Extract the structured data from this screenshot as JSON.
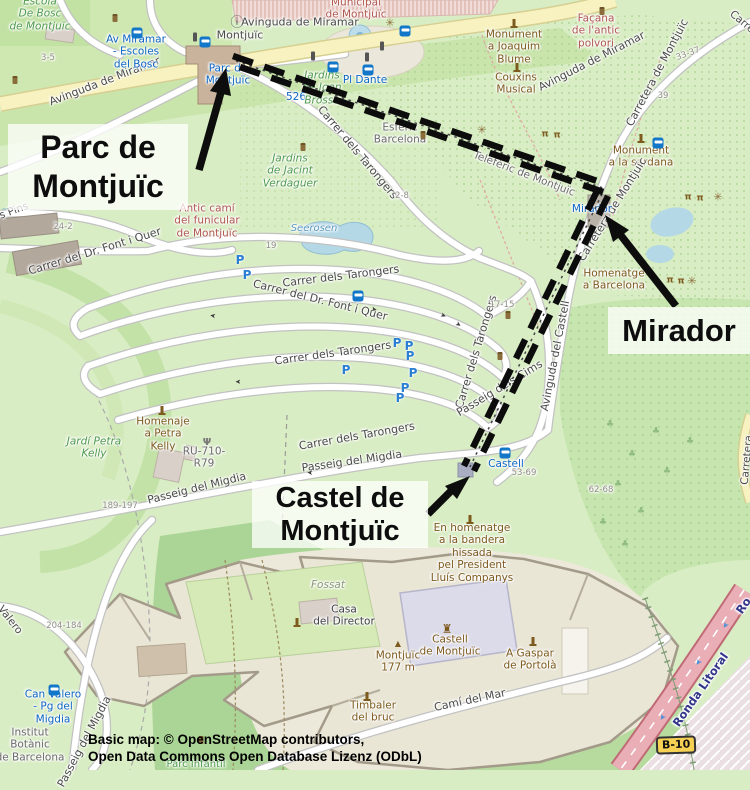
{
  "annotations": {
    "parc": "Parc de\nMontjuïc",
    "mirador": "Mirador",
    "castel": "Castel de\nMontjuïc"
  },
  "attribution": [
    "Basic map: © OpenStreetMap contributors,",
    "Open Data Commons Open Database Lizenz (ODbL)"
  ],
  "badges": {
    "b10": "B-10"
  },
  "colors": {
    "route": "#0c0c0c",
    "annotation_bg": "rgba(255,255,255,0.75)",
    "park_green": "#d9edc4",
    "forest_green": "#abd596",
    "water": "#b7d9e6",
    "road_yellow": "#f7f2c0",
    "trunk_red": "#e9aeb6",
    "transit_blue": "#0d66c3",
    "poi_brown": "#7d5a1e",
    "badge_yellow": "#f7d154"
  },
  "map_labels": [
    {
      "id": "escola-bosc",
      "text": "Escola\nDe Bosc\nde Montjuïc",
      "x": 40,
      "y": 14,
      "rot": 0,
      "cls": "gi"
    },
    {
      "id": "av-miramar-w",
      "text": "Avinguda de Miramar",
      "x": 105,
      "y": 82,
      "rot": -21,
      "cls": "st2"
    },
    {
      "id": "hn-3-5",
      "text": "3-5",
      "x": 48,
      "y": 58,
      "rot": 0,
      "cls": "hn"
    },
    {
      "id": "stop-av-miramar",
      "text": "Av Miramar\n- Escoles\ndel Bosc",
      "x": 136,
      "y": 52,
      "rot": 0,
      "cls": "tr"
    },
    {
      "id": "montjuic-street",
      "text": "Montjuïc",
      "x": 240,
      "y": 36,
      "rot": 0,
      "cls": "st2"
    },
    {
      "id": "municipal",
      "text": "Municipal\nde Montjuïc",
      "x": 356,
      "y": 9,
      "rot": 0,
      "cls": "ar"
    },
    {
      "id": "av-miramar-c",
      "text": "Avinguda de Miramar",
      "x": 300,
      "y": 23,
      "rot": 0,
      "cls": "st2"
    },
    {
      "id": "av-miramar-e",
      "text": "Avinguda de Miramar",
      "x": 592,
      "y": 62,
      "rot": -27,
      "cls": "st2"
    },
    {
      "id": "pl-dante",
      "text": "Pl Dante",
      "x": 365,
      "y": 80,
      "rot": 0,
      "cls": "tr"
    },
    {
      "id": "line-526",
      "text": "526",
      "x": 296,
      "y": 97,
      "rot": 0,
      "cls": "tr"
    },
    {
      "id": "jardins-brossa",
      "text": "Jardins\nde Joan\nBrossa",
      "x": 322,
      "y": 88,
      "rot": 0,
      "cls": "gi"
    },
    {
      "id": "stop-parc-montjuic",
      "text": "Parc de\nMontjuïc",
      "x": 228,
      "y": 75,
      "rot": 0,
      "cls": "tr"
    },
    {
      "id": "esferic",
      "text": "Esfèric\nBarcelona",
      "x": 400,
      "y": 134,
      "rot": 0,
      "cls": "gr"
    },
    {
      "id": "mon-blume",
      "text": "Monument\na Joaquim\nBlume",
      "x": 514,
      "y": 47,
      "rot": 0,
      "cls": "po"
    },
    {
      "id": "couxins",
      "text": "Couxins\nMusical",
      "x": 516,
      "y": 84,
      "rot": 0,
      "cls": "po"
    },
    {
      "id": "facana",
      "text": "Façana\nde l'antic\npolvori",
      "x": 596,
      "y": 31,
      "rot": 0,
      "cls": "ar"
    },
    {
      "id": "carretera-ne",
      "text": "Carretera de Montjuïc",
      "x": 658,
      "y": 73,
      "rot": -62,
      "cls": "st2"
    },
    {
      "id": "hn-33-37",
      "text": "33-37",
      "x": 688,
      "y": 54,
      "rot": -20,
      "cls": "hn"
    },
    {
      "id": "hn-39",
      "text": "39",
      "x": 663,
      "y": 96,
      "rot": 0,
      "cls": "hn"
    },
    {
      "id": "carre-corner",
      "text": "Carre",
      "x": 742,
      "y": 22,
      "rot": 40,
      "cls": "st"
    },
    {
      "id": "mon-sardana",
      "text": "Monument\na la sardana",
      "x": 641,
      "y": 157,
      "rot": 0,
      "cls": "po"
    },
    {
      "id": "teleferic",
      "text": "Telefèric de Montjuïc",
      "x": 524,
      "y": 174,
      "rot": 21,
      "cls": "gr"
    },
    {
      "id": "carretera-mid",
      "text": "Carretera de Montjuïc",
      "x": 613,
      "y": 210,
      "rot": -58,
      "cls": "st2"
    },
    {
      "id": "stop-mirador",
      "text": "Mirador",
      "x": 592,
      "y": 209,
      "rot": 0,
      "cls": "tr"
    },
    {
      "id": "homenatge-bcn",
      "text": "Homenatge\na Barcelona",
      "x": 614,
      "y": 280,
      "rot": 0,
      "cls": "po"
    },
    {
      "id": "antic-cami",
      "text": "Antic camí\ndel funicular\nde Montjuïc",
      "x": 207,
      "y": 221,
      "rot": 0,
      "cls": "ar"
    },
    {
      "id": "tarongers-1",
      "text": "Carrer dels Tarongers",
      "x": 357,
      "y": 153,
      "rot": 50,
      "cls": "st2"
    },
    {
      "id": "tarongers-2",
      "text": "Carrer dels Tarongers",
      "x": 341,
      "y": 277,
      "rot": -7,
      "cls": "st2"
    },
    {
      "id": "font-quer-1",
      "text": "Carrer del Dr. Font i Quer",
      "x": 320,
      "y": 301,
      "rot": 14,
      "cls": "st2"
    },
    {
      "id": "font-quer-2",
      "text": "Carrer del Dr. Font i Quer",
      "x": 95,
      "y": 252,
      "rot": -17,
      "cls": "st2"
    },
    {
      "id": "s-pins",
      "text": "s Pins",
      "x": 14,
      "y": 211,
      "rot": -20,
      "cls": "st"
    },
    {
      "id": "hn-24-2",
      "text": "24-2",
      "x": 63,
      "y": 227,
      "rot": 0,
      "cls": "hn"
    },
    {
      "id": "tarongers-3",
      "text": "Carrer dels Tarongers",
      "x": 333,
      "y": 354,
      "rot": -8,
      "cls": "st2"
    },
    {
      "id": "tarongers-4",
      "text": "Carrer dels Tarongers",
      "x": 477,
      "y": 352,
      "rot": -73,
      "cls": "st2"
    },
    {
      "id": "tarongers-5",
      "text": "Carrer dels Tarongers",
      "x": 357,
      "y": 437,
      "rot": -10,
      "cls": "st2"
    },
    {
      "id": "hn-2-8",
      "text": "2-8",
      "x": 402,
      "y": 196,
      "rot": 0,
      "cls": "hn"
    },
    {
      "id": "hn-19",
      "text": "19",
      "x": 271,
      "y": 246,
      "rot": 0,
      "cls": "hn"
    },
    {
      "id": "seerosen",
      "text": "Seerosen",
      "x": 314,
      "y": 229,
      "rot": 0,
      "cls": "wa"
    },
    {
      "id": "jacint-verdaguer",
      "text": "Jardins\nde Jacint\nVerdaguer",
      "x": 290,
      "y": 171,
      "rot": 0,
      "cls": "gi"
    },
    {
      "id": "hn-17-15",
      "text": "17-15",
      "x": 502,
      "y": 305,
      "rot": 0,
      "cls": "hn"
    },
    {
      "id": "passeig-cims",
      "text": "Passeig dels Cims",
      "x": 500,
      "y": 389,
      "rot": -31,
      "cls": "st2"
    },
    {
      "id": "av-castell",
      "text": "Avinguda del Castell",
      "x": 556,
      "y": 356,
      "rot": -79,
      "cls": "st2"
    },
    {
      "id": "stop-castell",
      "text": "Castell",
      "x": 506,
      "y": 464,
      "rot": 0,
      "cls": "tr"
    },
    {
      "id": "hn-53-69",
      "text": "53-69",
      "x": 524,
      "y": 473,
      "rot": 0,
      "cls": "hn"
    },
    {
      "id": "hn-62-68",
      "text": "62-68",
      "x": 601,
      "y": 490,
      "rot": 0,
      "cls": "hn"
    },
    {
      "id": "homenaje-petra",
      "text": "Homenaje\na Petra\nKelly",
      "x": 163,
      "y": 434,
      "rot": 0,
      "cls": "po"
    },
    {
      "id": "ru-710",
      "text": "RU-710-\nR79",
      "x": 204,
      "y": 458,
      "rot": 0,
      "cls": "gr"
    },
    {
      "id": "jardi-petra",
      "text": "Jardí Petra\nKelly",
      "x": 94,
      "y": 448,
      "rot": 0,
      "cls": "gi"
    },
    {
      "id": "migdia-1",
      "text": "Passeig del Migdia",
      "x": 352,
      "y": 462,
      "rot": -8,
      "cls": "st2"
    },
    {
      "id": "migdia-2",
      "text": "Passeig del Migdia",
      "x": 197,
      "y": 489,
      "rot": -14,
      "cls": "st2"
    },
    {
      "id": "hn-189-197",
      "text": "189-197",
      "x": 120,
      "y": 506,
      "rot": 0,
      "cls": "hn"
    },
    {
      "id": "hn-204-184",
      "text": "204-184",
      "x": 64,
      "y": 626,
      "rot": 0,
      "cls": "hn"
    },
    {
      "id": "valero-road",
      "text": "Valero",
      "x": 10,
      "y": 620,
      "rot": 52,
      "cls": "st"
    },
    {
      "id": "stop-can-valero",
      "text": "Can Valero\n- Pg del\nMigdia",
      "x": 53,
      "y": 707,
      "rot": 0,
      "cls": "tr"
    },
    {
      "id": "institut-botanic",
      "text": "Institut\nBotànic\nde Barcelona",
      "x": 30,
      "y": 745,
      "rot": 0,
      "cls": "gr"
    },
    {
      "id": "migdia-3",
      "text": "Passeig del Migdia",
      "x": 85,
      "y": 742,
      "rot": -62,
      "cls": "st2"
    },
    {
      "id": "parc-infantil",
      "text": "Parc Infantil",
      "x": 196,
      "y": 765,
      "rot": 0,
      "cls": "gl"
    },
    {
      "id": "fossat",
      "text": "Fossat",
      "x": 328,
      "y": 585,
      "rot": 0,
      "cls": "fo"
    },
    {
      "id": "casa-director",
      "text": "Casa\ndel Director",
      "x": 344,
      "y": 616,
      "rot": 0,
      "cls": "dk"
    },
    {
      "id": "castell-poi",
      "text": "Castell\nde Montjuïc",
      "x": 450,
      "y": 646,
      "rot": 0,
      "cls": "po"
    },
    {
      "id": "peak-montjuic",
      "text": "Montjuïc\n177 m",
      "x": 398,
      "y": 662,
      "rot": 0,
      "cls": "po"
    },
    {
      "id": "gaspar-portola",
      "text": "A Gaspar\nde Portolà",
      "x": 530,
      "y": 660,
      "rot": 0,
      "cls": "po"
    },
    {
      "id": "timbaler",
      "text": "Timbaler\ndel bruc",
      "x": 373,
      "y": 712,
      "rot": 0,
      "cls": "po"
    },
    {
      "id": "cami-mar",
      "text": "Camí del Mar",
      "x": 470,
      "y": 701,
      "rot": -12,
      "cls": "st2"
    },
    {
      "id": "en-homenatge",
      "text": "En homenatge\na la bandera\nhissada\npel President\nLluís Companys",
      "x": 472,
      "y": 553,
      "rot": 0,
      "cls": "po"
    },
    {
      "id": "ronda-litoral",
      "text": "Ronda Litoral",
      "x": 701,
      "y": 690,
      "rot": -55,
      "cls": "rl"
    },
    {
      "id": "ronda-2",
      "text": "Ro",
      "x": 744,
      "y": 606,
      "rot": -55,
      "cls": "rl"
    },
    {
      "id": "carretera-se",
      "text": "Carretera",
      "x": 747,
      "y": 460,
      "rot": -85,
      "cls": "st"
    }
  ],
  "icons": [
    {
      "t": "bus",
      "x": 137,
      "y": 33
    },
    {
      "t": "bus",
      "x": 205,
      "y": 42
    },
    {
      "t": "bus",
      "x": 405,
      "y": 31
    },
    {
      "t": "bus",
      "x": 368,
      "y": 70
    },
    {
      "t": "bus",
      "x": 658,
      "y": 143
    },
    {
      "t": "bus",
      "x": 505,
      "y": 453
    },
    {
      "t": "bus",
      "x": 54,
      "y": 690
    },
    {
      "t": "bus",
      "x": 358,
      "y": 296
    },
    {
      "t": "taxi",
      "x": 333,
      "y": 67
    },
    {
      "t": "info",
      "x": 237,
      "y": 23,
      "g": "ⓘ"
    },
    {
      "t": "traffic",
      "x": 195,
      "y": 37
    },
    {
      "t": "traffic",
      "x": 313,
      "y": 56
    },
    {
      "t": "traffic",
      "x": 382,
      "y": 46
    },
    {
      "t": "traffic",
      "x": 367,
      "y": 57
    },
    {
      "t": "parking",
      "x": 240,
      "y": 260,
      "g": "P"
    },
    {
      "t": "parking",
      "x": 247,
      "y": 275,
      "g": "P"
    },
    {
      "t": "parking",
      "x": 397,
      "y": 343,
      "g": "P"
    },
    {
      "t": "parking",
      "x": 409,
      "y": 346,
      "g": "P"
    },
    {
      "t": "parking",
      "x": 410,
      "y": 356,
      "g": "P"
    },
    {
      "t": "parking",
      "x": 346,
      "y": 370,
      "g": "P"
    },
    {
      "t": "parking",
      "x": 413,
      "y": 373,
      "g": "P"
    },
    {
      "t": "parking",
      "x": 405,
      "y": 388,
      "g": "P"
    },
    {
      "t": "parking",
      "x": 400,
      "y": 398,
      "g": "P"
    },
    {
      "t": "monument",
      "x": 514,
      "y": 23
    },
    {
      "t": "monument",
      "x": 517,
      "y": 67
    },
    {
      "t": "monument",
      "x": 641,
      "y": 138
    },
    {
      "t": "monument",
      "x": 470,
      "y": 519
    },
    {
      "t": "monument",
      "x": 533,
      "y": 641
    },
    {
      "t": "monument",
      "x": 367,
      "y": 696
    },
    {
      "t": "monument",
      "x": 297,
      "y": 622
    },
    {
      "t": "monument",
      "x": 162,
      "y": 410
    },
    {
      "t": "picnic",
      "x": 545,
      "y": 135,
      "g": "π"
    },
    {
      "t": "picnic",
      "x": 557,
      "y": 136,
      "g": "π"
    },
    {
      "t": "picnic",
      "x": 688,
      "y": 198,
      "g": "π"
    },
    {
      "t": "picnic",
      "x": 700,
      "y": 199,
      "g": "π"
    },
    {
      "t": "picnic",
      "x": 670,
      "y": 281,
      "g": "π"
    },
    {
      "t": "picnic",
      "x": 681,
      "y": 282,
      "g": "π"
    },
    {
      "t": "star",
      "x": 390,
      "y": 23,
      "g": "✳"
    },
    {
      "t": "star",
      "x": 482,
      "y": 130,
      "g": "✳"
    },
    {
      "t": "star",
      "x": 718,
      "y": 197,
      "g": "✳"
    },
    {
      "t": "star",
      "x": 692,
      "y": 281,
      "g": "✳"
    },
    {
      "t": "bin",
      "x": 115,
      "y": 18
    },
    {
      "t": "bin",
      "x": 15,
      "y": 80
    },
    {
      "t": "bin",
      "x": 303,
      "y": 147
    },
    {
      "t": "bin",
      "x": 423,
      "y": 135
    },
    {
      "t": "bin",
      "x": 602,
      "y": 11
    },
    {
      "t": "bin",
      "x": 508,
      "y": 315
    },
    {
      "t": "bin",
      "x": 500,
      "y": 356
    },
    {
      "t": "bin",
      "x": 201,
      "y": 740
    },
    {
      "t": "antenna",
      "x": 207,
      "y": 443,
      "g": "Ψ"
    },
    {
      "t": "castle",
      "x": 447,
      "y": 629,
      "g": "♜"
    },
    {
      "t": "peak",
      "x": 398,
      "y": 644,
      "g": "▲"
    },
    {
      "t": "oneway",
      "x": 238,
      "y": 381,
      "g": "➤",
      "r": 180
    },
    {
      "t": "oneway",
      "x": 374,
      "y": 310,
      "g": "➤",
      "r": 15
    },
    {
      "t": "oneway",
      "x": 443,
      "y": 316,
      "g": "➤",
      "r": 25
    },
    {
      "t": "oneway",
      "x": 458,
      "y": 325,
      "g": "➤",
      "r": 35
    },
    {
      "t": "oneway",
      "x": 310,
      "y": 472,
      "g": "➤",
      "r": 183
    },
    {
      "t": "oneway",
      "x": 213,
      "y": 315,
      "g": "➤",
      "r": 190
    },
    {
      "t": "tree",
      "x": 610,
      "y": 425,
      "g": "♣"
    },
    {
      "t": "tree",
      "x": 632,
      "y": 455,
      "g": "♣"
    },
    {
      "t": "tree",
      "x": 656,
      "y": 432,
      "g": "♣"
    },
    {
      "t": "tree",
      "x": 618,
      "y": 485,
      "g": "♣"
    },
    {
      "t": "tree",
      "x": 641,
      "y": 512,
      "g": "♣"
    },
    {
      "t": "tree",
      "x": 603,
      "y": 523,
      "g": "♣"
    },
    {
      "t": "tree",
      "x": 667,
      "y": 472,
      "g": "♣"
    },
    {
      "t": "tree",
      "x": 690,
      "y": 442,
      "g": "♣"
    },
    {
      "t": "tree",
      "x": 625,
      "y": 545,
      "g": "♣"
    },
    {
      "t": "ronda-arrow",
      "x": 725,
      "y": 625,
      "g": "➤",
      "r": 125
    },
    {
      "t": "ronda-arrow",
      "x": 698,
      "y": 662,
      "g": "➤",
      "r": 125
    },
    {
      "t": "ronda-arrow",
      "x": 662,
      "y": 717,
      "g": "➤",
      "r": 125
    }
  ]
}
